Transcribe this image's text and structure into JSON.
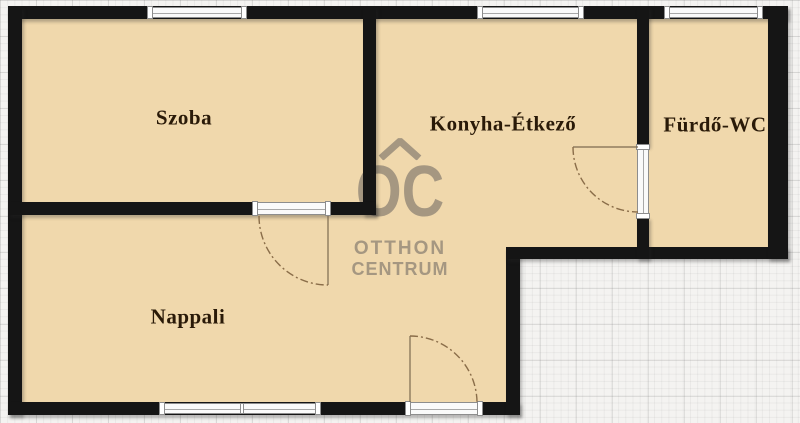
{
  "page": {
    "type": "real-estate floor plan"
  },
  "rooms": [
    {
      "id": "szoba",
      "label": "Szoba"
    },
    {
      "id": "konyha-etkezo",
      "label": "Konyha-Étkező"
    },
    {
      "id": "furdo-wc",
      "label": "Fürdő-WC"
    },
    {
      "id": "nappali",
      "label": "Nappali"
    }
  ],
  "watermark": {
    "logo_text": "OC",
    "line1": "OTTHON",
    "line2": "CENTRUM"
  },
  "colors": {
    "floor": "#f0d8ac",
    "wall": "#151515",
    "grid_background": "#f4f3f1",
    "label_text": "#2a1a08",
    "watermark": "#a59781",
    "door_swing": "#8a6d49",
    "window_fill": "#fafafa",
    "window_border": "#8d8d8d"
  }
}
